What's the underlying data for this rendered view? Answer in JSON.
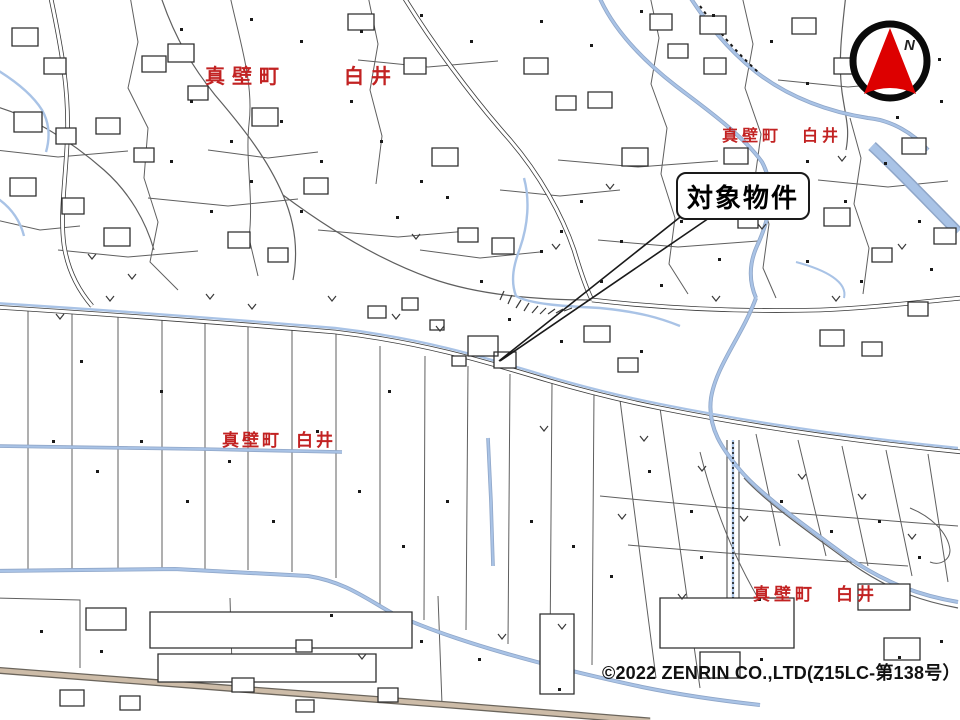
{
  "map": {
    "district_labels": [
      {
        "position": "top-left",
        "town": "真壁町",
        "area": "白井"
      },
      {
        "position": "top-right",
        "town": "真壁町",
        "area": "白井"
      },
      {
        "position": "middle-left",
        "town": "真壁町",
        "area": "白井"
      },
      {
        "position": "bottom-right",
        "town": "真壁町",
        "area": "白井"
      }
    ],
    "callout": {
      "text": "対象物件"
    },
    "compass": {
      "direction_label": "N"
    },
    "copyright": "©2022 ZENRIN CO.,LTD(Z15LC-第138号）",
    "colors": {
      "district_label_red": "#c22222",
      "compass_needle_red": "#dd0000",
      "water_blue": "#a9c3e6",
      "water_edge_blue": "#8fa6c8",
      "road_tan": "#cdbca8",
      "map_line_gray": "#5f5f5f",
      "building_line": "#2e2e2e"
    }
  }
}
